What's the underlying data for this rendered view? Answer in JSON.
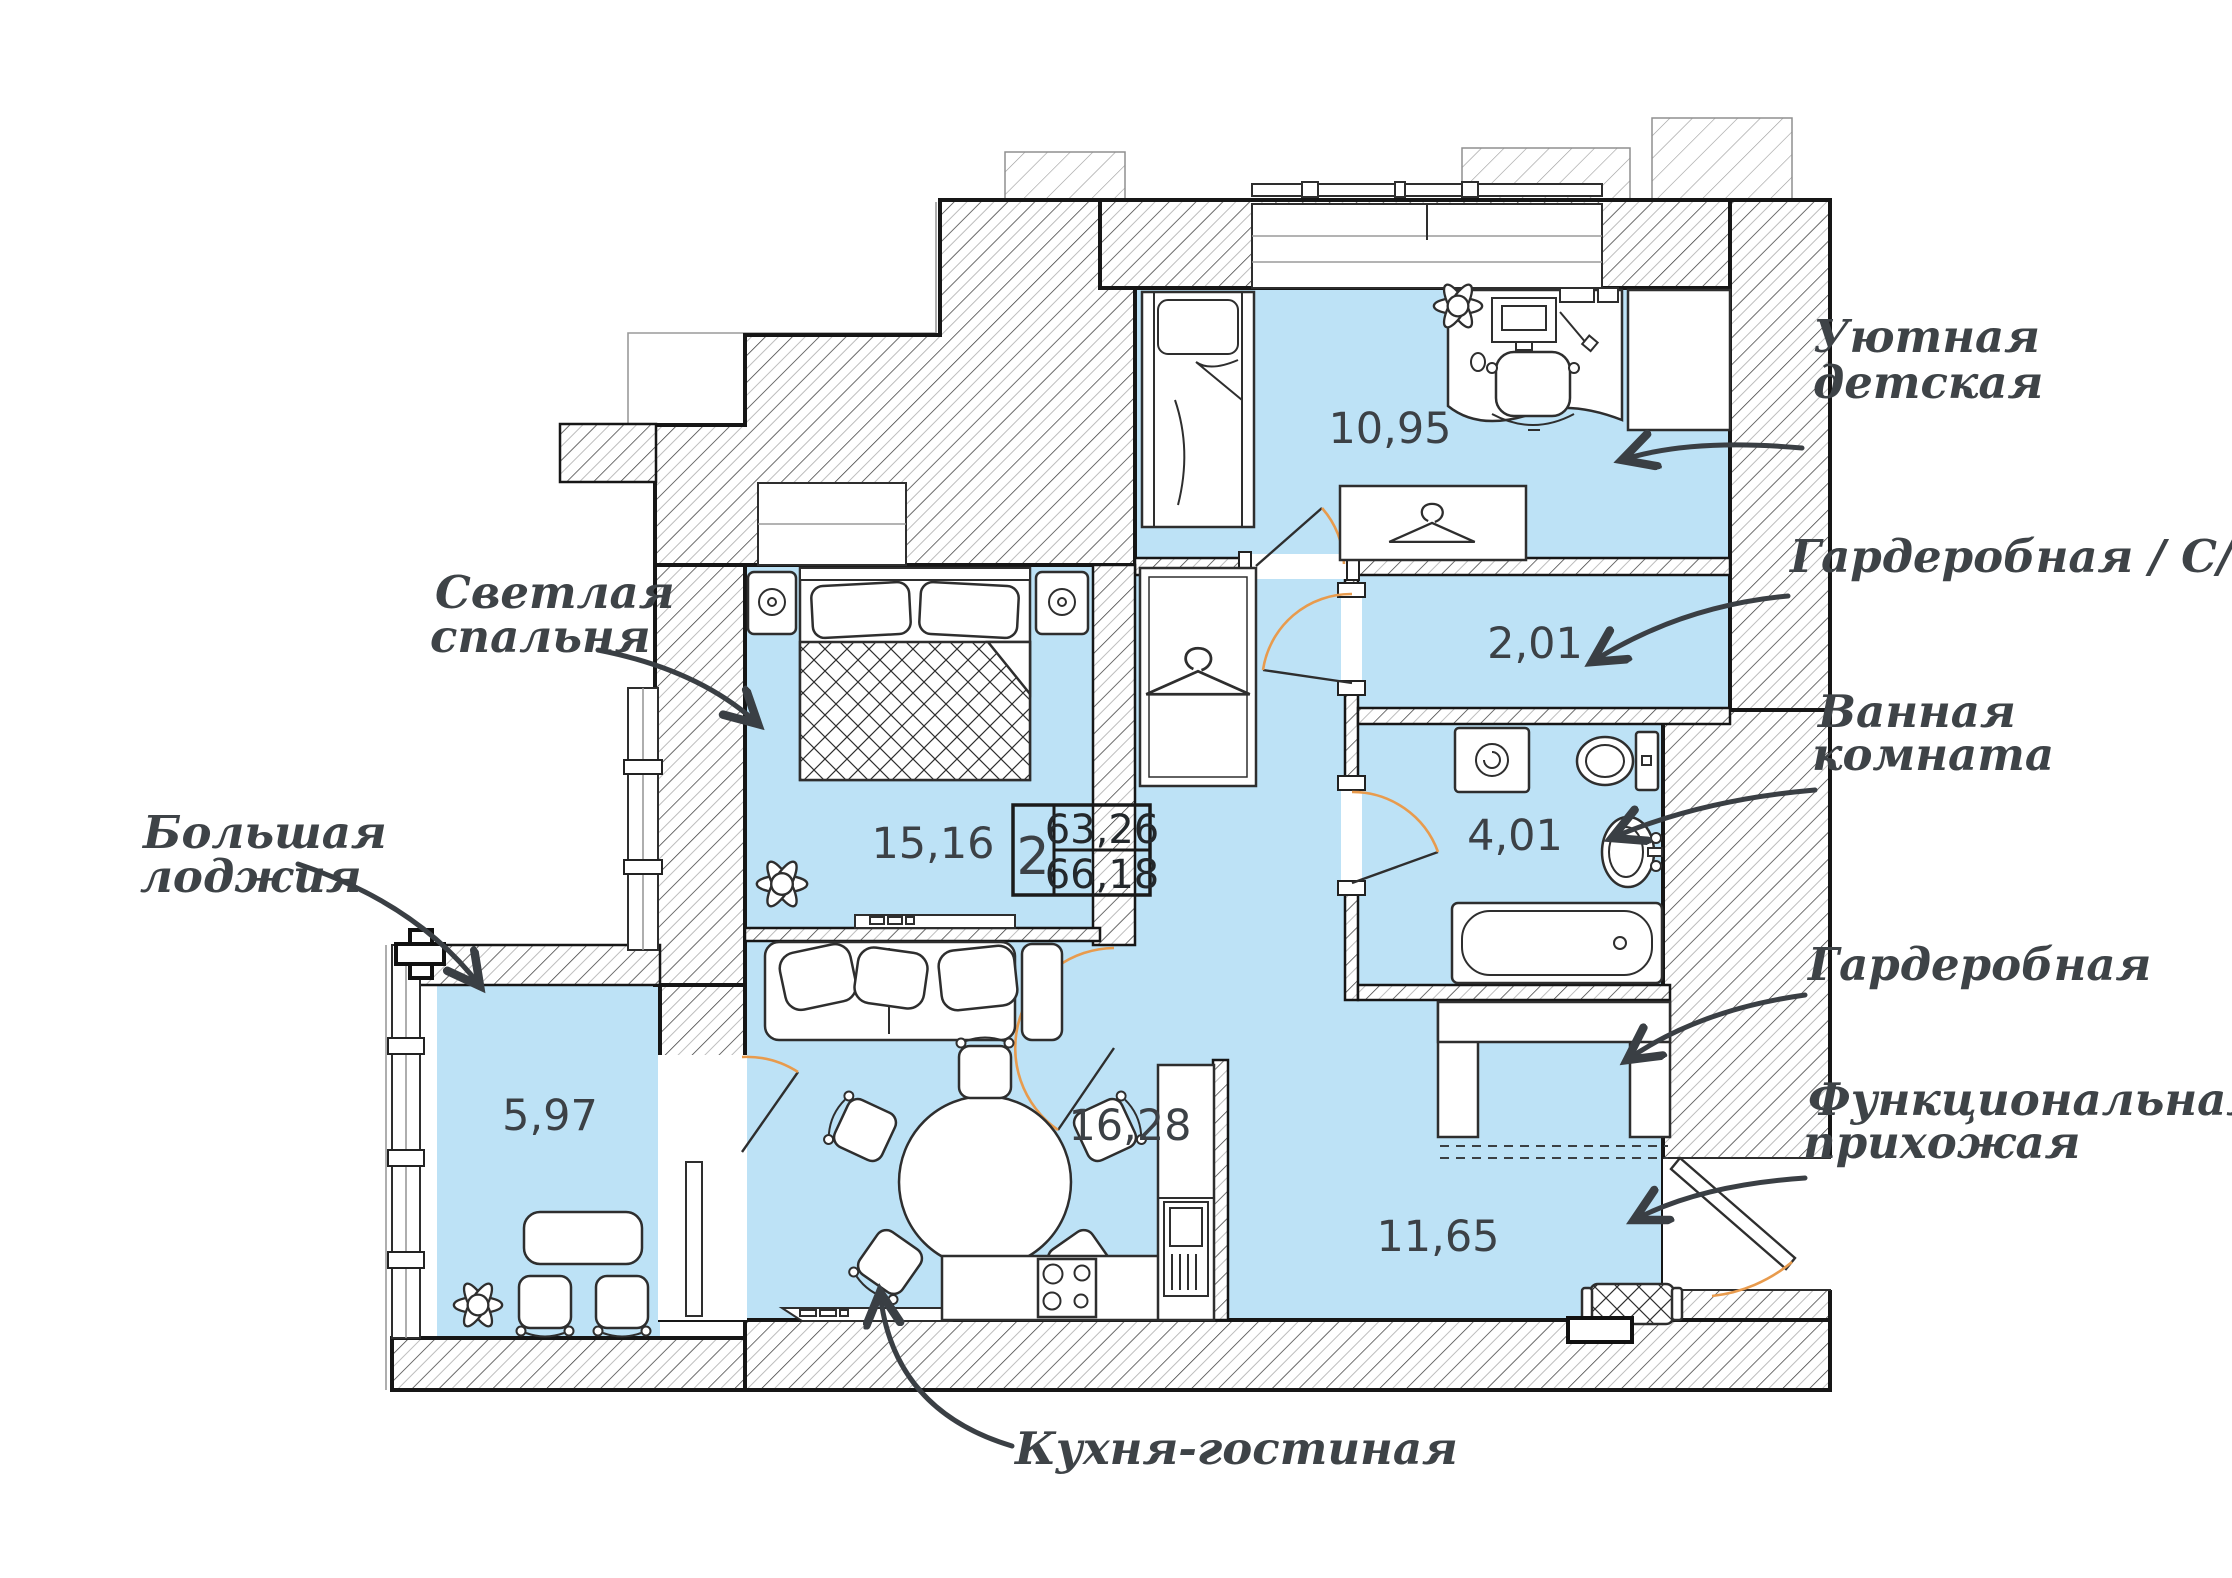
{
  "plan": {
    "unit": {
      "rooms_count": "2",
      "area_living": "63,26",
      "area_total": "66,18"
    },
    "rooms": [
      {
        "name": "children",
        "area": "10,95"
      },
      {
        "name": "wardrobe-wc",
        "area": "2,01"
      },
      {
        "name": "bathroom",
        "area": "4,01"
      },
      {
        "name": "bedroom",
        "area": "15,16"
      },
      {
        "name": "kitchen-living",
        "area": "16,28"
      },
      {
        "name": "hallway",
        "area": "11,65"
      },
      {
        "name": "loggia",
        "area": "5,97"
      }
    ],
    "callouts": {
      "children": {
        "line1": "Уютная",
        "line2": "детская"
      },
      "wardrobe_wc": {
        "line1": "Гардеробная / С/у"
      },
      "bathroom": {
        "line1": "Ванная",
        "line2": "комната"
      },
      "wardrobe": {
        "line1": "Гардеробная"
      },
      "hallway": {
        "line1": "Функциональная",
        "line2": "прихожая"
      },
      "kitchen": {
        "line1": "Кухня-гостиная"
      },
      "bedroom": {
        "line1": "Светлая",
        "line2": "спальня"
      },
      "loggia": {
        "line1": "Большая",
        "line2": "лоджия"
      }
    },
    "colors": {
      "room_fill": "#BDE2F6",
      "door_arc": "#E89B4D",
      "ink": "#1C1C1C",
      "label": "#3E4347"
    }
  }
}
